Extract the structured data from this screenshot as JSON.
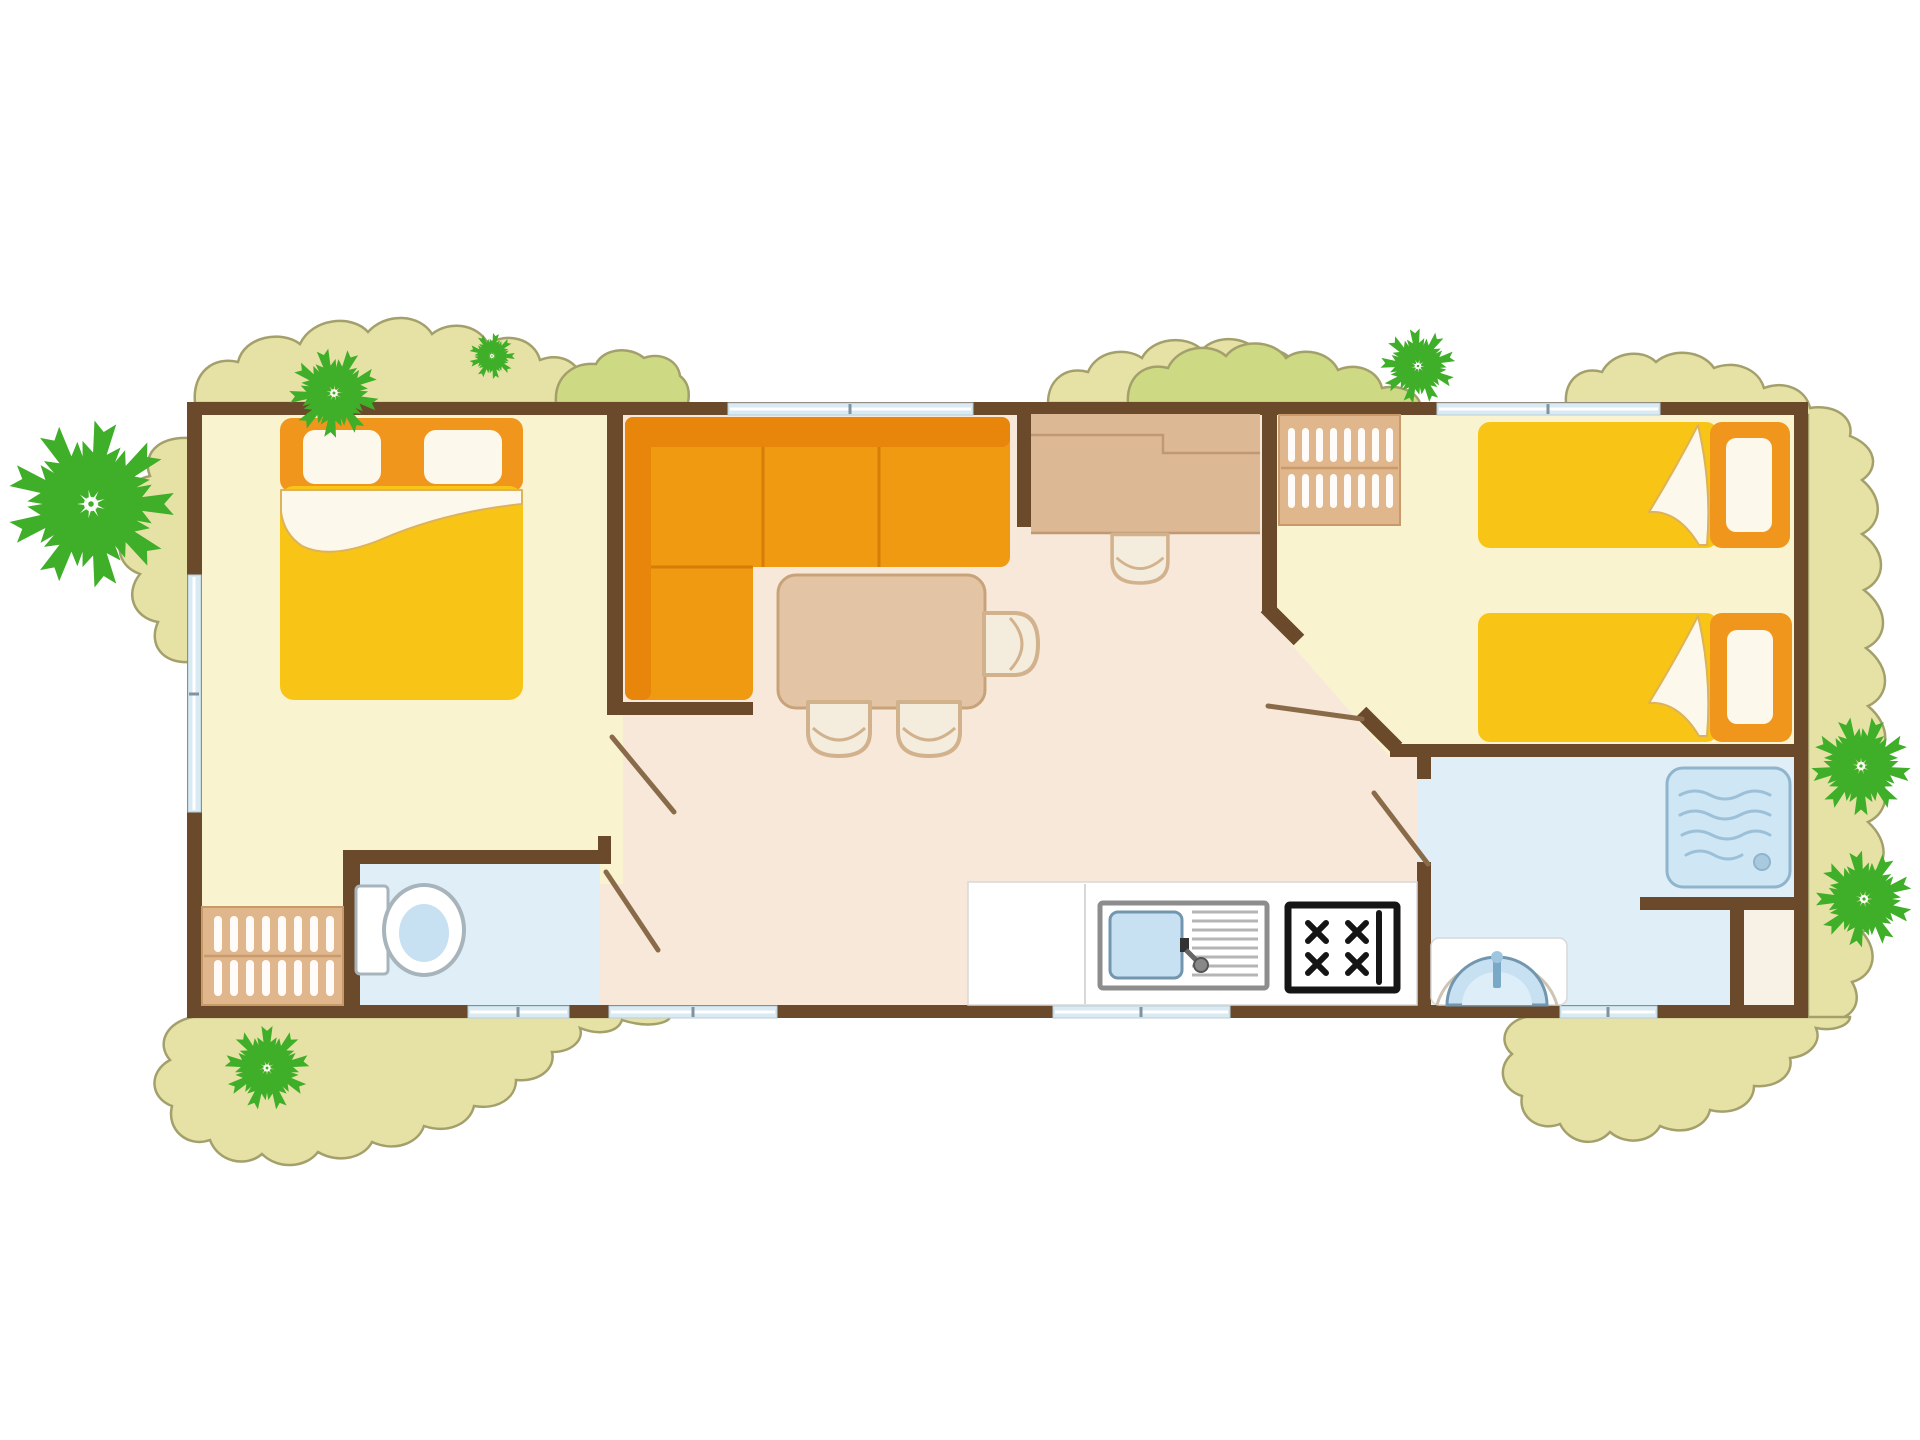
{
  "meta": {
    "label": "mobile-home-floor-plan",
    "type": "floor-plan-illustration",
    "visible_text": []
  },
  "colors": {
    "background": "#ffffff",
    "foliage": "#e6e2a6",
    "foliage_green": "#cdda83",
    "foliage_stroke": "#a3a06b",
    "palm": "#3fae28",
    "wall": "#6b4a2b",
    "door": "#8a6b49",
    "bedroom_floor": "#faf3cf",
    "hall_floor": "#f7e8da",
    "wet_floor": "#dfeef7",
    "niche_floor": "#f8f2e6",
    "window": "#d9eaf3",
    "window_frame": "#b8cdd9",
    "window_tick": "#7f93a0",
    "bed_yellow": "#f8c517",
    "bed_orange": "#f0961c",
    "linen": "#fdf8ec",
    "sheet_edge": "#dcb25c",
    "sofa": "#f09a12",
    "sofa_dark": "#e8860c",
    "sofa_seam": "#d67c08",
    "table": "#e3c5a5",
    "table_stroke": "#c8a379",
    "chair_fill": "#f4ecdd",
    "chair_stroke": "#d2b28c",
    "desk": "#dcb894",
    "desk_line": "#c09872",
    "closet": "#e0b68c",
    "closet_line": "#c89a6a",
    "counter": "#ffffff",
    "counter_line": "#d8d8d8",
    "sink_basin": "#c7e0f2",
    "sink_basin_stroke": "#7296ad",
    "sink_inner": "#ddeef8",
    "sink_stroke": "#8d8d8d",
    "drain_line": "#b5b5b5",
    "stove": "#151515",
    "shower_fill": "#cfe6f4",
    "shower_stroke": "#8fb4cc",
    "wave": "#9cc0d8",
    "fixture_stroke": "#a8b4bc",
    "faucet": "#7aa9c8"
  },
  "rooms": [
    {
      "name": "master-bedroom",
      "floor": "cream"
    },
    {
      "name": "living-dining-area",
      "floor": "pink-beige"
    },
    {
      "name": "kitchen-corner",
      "floor": "white"
    },
    {
      "name": "twin-bedroom",
      "floor": "cream"
    },
    {
      "name": "shower-room",
      "floor": "light-blue"
    },
    {
      "name": "wc",
      "floor": "light-blue"
    }
  ],
  "furniture": {
    "master_bedroom": [
      "double-bed",
      "wardrobe"
    ],
    "living": [
      "corner-sofa",
      "dining-table",
      "dining-chairs",
      "desk-unit",
      "desk-stool",
      "hanging-closet"
    ],
    "kitchen": [
      "worktop",
      "sink-with-drainboard",
      "gas-hob-4-burners"
    ],
    "twin_bedroom": [
      "single-bed",
      "single-bed"
    ],
    "shower_room": [
      "shower-tray",
      "washbasin"
    ],
    "wc": [
      "toilet"
    ]
  },
  "outdoor": {
    "palm_tree_count": 7,
    "bush_cluster_count": 7
  },
  "windows": {
    "top": 2,
    "bottom": 4,
    "left": 1
  },
  "doors_open_leaves": 4
}
